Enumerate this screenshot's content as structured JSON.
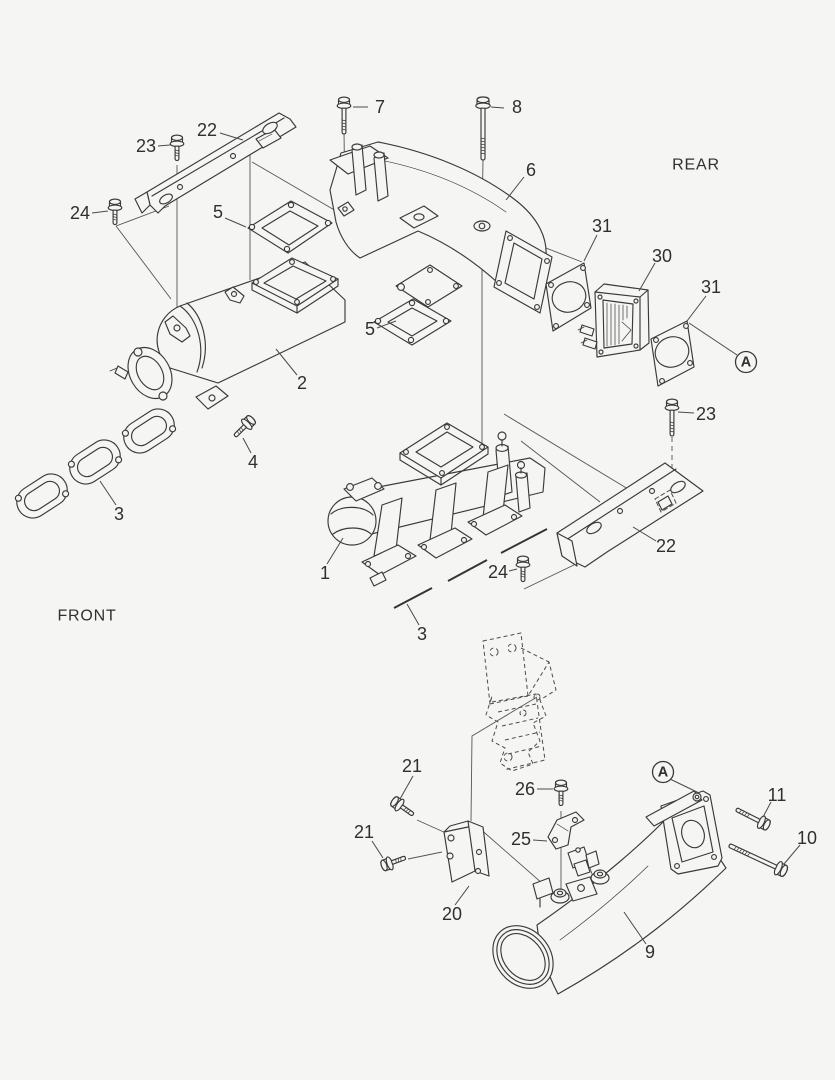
{
  "figure": {
    "type": "exploded-parts-diagram",
    "background": "#f5f5f3",
    "line_color": "#3a3a3a",
    "label_color": "#2f2f2f"
  },
  "orientation_labels": [
    {
      "text": "REAR",
      "x": 696,
      "y": 165
    },
    {
      "text": "FRONT",
      "x": 87,
      "y": 616
    }
  ],
  "ref_markers": [
    {
      "text": "A",
      "cx": 746,
      "cy": 362,
      "r": 10.5,
      "leader": [
        [
          737,
          355
        ],
        [
          689,
          323
        ]
      ]
    },
    {
      "text": "A",
      "cx": 663,
      "cy": 772,
      "r": 10.5,
      "leader": [
        [
          670,
          779
        ],
        [
          699,
          793
        ]
      ]
    }
  ],
  "callouts": [
    {
      "text": "7",
      "x": 380,
      "y": 107,
      "leader": [
        [
          368,
          107
        ],
        [
          353,
          107
        ]
      ]
    },
    {
      "text": "8",
      "x": 517,
      "y": 107,
      "leader": [
        [
          504,
          108
        ],
        [
          491,
          107
        ]
      ]
    },
    {
      "text": "22",
      "x": 207,
      "y": 130,
      "leader": [
        [
          220,
          133
        ],
        [
          243,
          140
        ]
      ]
    },
    {
      "text": "23",
      "x": 146,
      "y": 146,
      "leader": [
        [
          158,
          146
        ],
        [
          170,
          145
        ]
      ]
    },
    {
      "text": "24",
      "x": 80,
      "y": 213,
      "leader": [
        [
          92,
          213
        ],
        [
          108,
          211
        ]
      ]
    },
    {
      "text": "5",
      "x": 218,
      "y": 212,
      "leader": [
        [
          225,
          218
        ],
        [
          246,
          227
        ]
      ]
    },
    {
      "text": "6",
      "x": 531,
      "y": 170,
      "leader": [
        [
          524,
          177
        ],
        [
          506,
          200
        ]
      ]
    },
    {
      "text": "31",
      "x": 602,
      "y": 226,
      "leader": [
        [
          597,
          235
        ],
        [
          584,
          261
        ]
      ]
    },
    {
      "text": "30",
      "x": 662,
      "y": 256,
      "leader": [
        [
          655,
          263
        ],
        [
          639,
          291
        ]
      ]
    },
    {
      "text": "31",
      "x": 711,
      "y": 287,
      "leader": [
        [
          706,
          296
        ],
        [
          687,
          321
        ]
      ]
    },
    {
      "text": "2",
      "x": 302,
      "y": 383,
      "leader": [
        [
          297,
          375
        ],
        [
          276,
          349
        ]
      ]
    },
    {
      "text": "5",
      "x": 370,
      "y": 329,
      "leader": [
        [
          377,
          328
        ],
        [
          396,
          321
        ]
      ]
    },
    {
      "text": "4",
      "x": 253,
      "y": 462,
      "leader": [
        [
          251,
          453
        ],
        [
          243,
          438
        ]
      ]
    },
    {
      "text": "3",
      "x": 119,
      "y": 514,
      "leader": [
        [
          116,
          505
        ],
        [
          100,
          481
        ]
      ]
    },
    {
      "text": "1",
      "x": 325,
      "y": 573,
      "leader": [
        [
          327,
          564
        ],
        [
          343,
          538
        ]
      ]
    },
    {
      "text": "23",
      "x": 706,
      "y": 414,
      "leader": [
        [
          694,
          413
        ],
        [
          678,
          412
        ]
      ]
    },
    {
      "text": "22",
      "x": 666,
      "y": 546,
      "leader": [
        [
          656,
          541
        ],
        [
          633,
          527
        ]
      ]
    },
    {
      "text": "24",
      "x": 498,
      "y": 572,
      "leader": [
        [
          509,
          571
        ],
        [
          517,
          569
        ]
      ]
    },
    {
      "text": "3",
      "x": 422,
      "y": 634,
      "leader": [
        [
          419,
          625
        ],
        [
          407,
          604
        ]
      ]
    },
    {
      "text": "21",
      "x": 412,
      "y": 766,
      "leader": [
        [
          413,
          776
        ],
        [
          400,
          799
        ]
      ]
    },
    {
      "text": "21",
      "x": 364,
      "y": 832,
      "leader": [
        [
          372,
          841
        ],
        [
          383,
          858
        ]
      ]
    },
    {
      "text": "26",
      "x": 525,
      "y": 789,
      "leader": [
        [
          537,
          789
        ],
        [
          553,
          789
        ]
      ]
    },
    {
      "text": "25",
      "x": 521,
      "y": 839,
      "leader": [
        [
          533,
          840
        ],
        [
          547,
          841
        ]
      ]
    },
    {
      "text": "20",
      "x": 452,
      "y": 914,
      "leader": [
        [
          455,
          905
        ],
        [
          469,
          886
        ]
      ]
    },
    {
      "text": "9",
      "x": 650,
      "y": 952,
      "leader": [
        [
          646,
          944
        ],
        [
          624,
          912
        ]
      ]
    },
    {
      "text": "11",
      "x": 777,
      "y": 795,
      "leader": [
        [
          771,
          802
        ],
        [
          763,
          817
        ]
      ]
    },
    {
      "text": "10",
      "x": 807,
      "y": 838,
      "leader": [
        [
          800,
          845
        ],
        [
          784,
          864
        ]
      ]
    }
  ]
}
